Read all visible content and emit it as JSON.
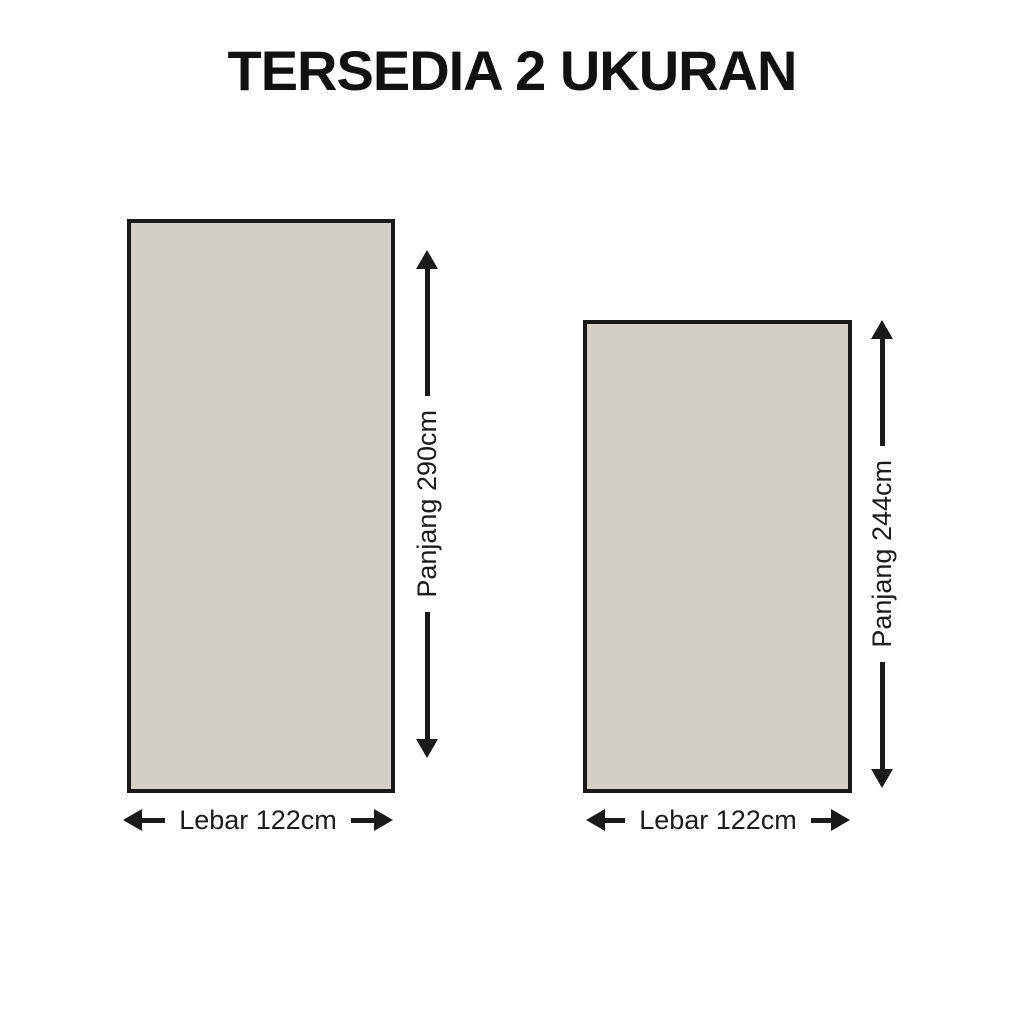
{
  "title": "TERSEDIA 2 UKURAN",
  "colors": {
    "background": "#ffffff",
    "panel_fill": "#d1cfc8",
    "line": "#1a1a1a"
  },
  "sizes": [
    {
      "length_label": "Panjang 290cm",
      "width_label": "Lebar 122cm"
    },
    {
      "length_label": "Panjang 244cm",
      "width_label": "Lebar 122cm"
    }
  ]
}
